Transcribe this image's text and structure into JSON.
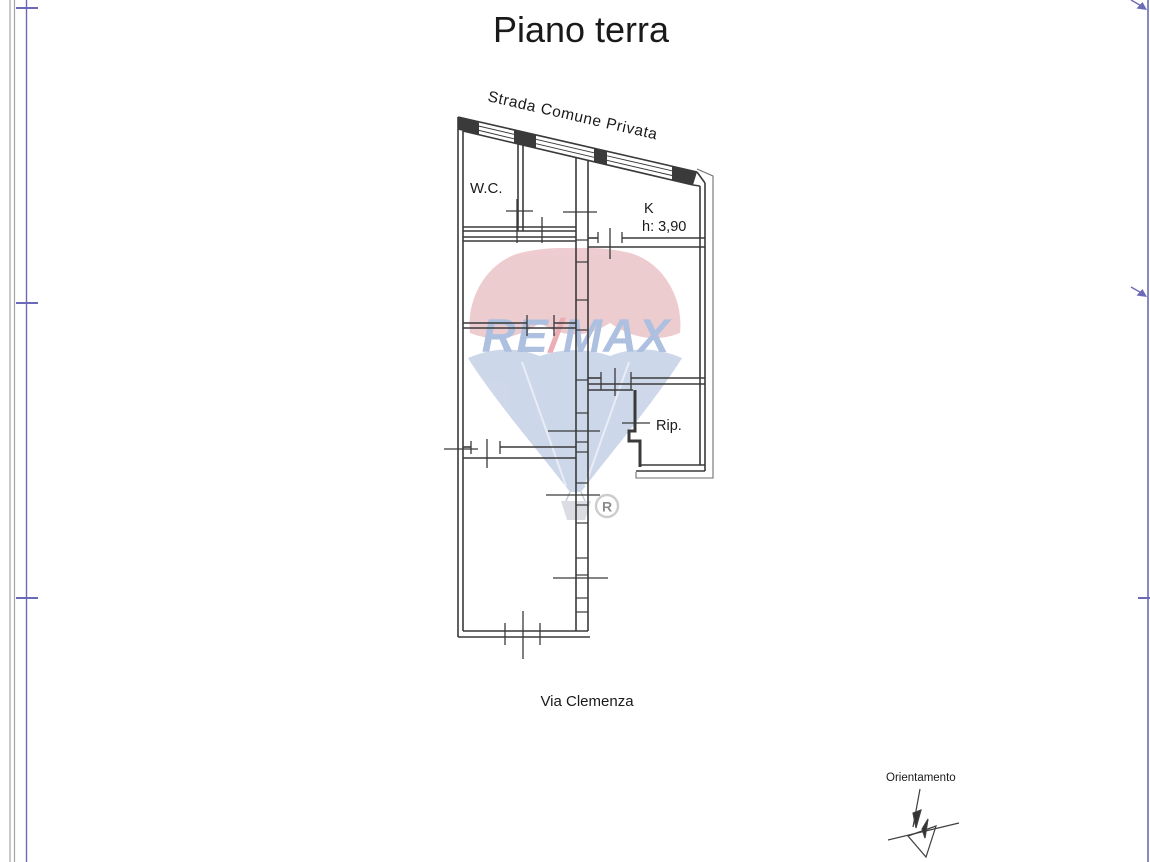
{
  "title": "Piano terra",
  "plan": {
    "street_top": "Strada Comune Privata",
    "street_bottom": "Via Clemenza",
    "room_wc": "W.C.",
    "room_kitchen": "K",
    "room_kitchen_height": "h: 3,90",
    "room_storage": "Rip."
  },
  "watermark": {
    "brand_re": "RE",
    "brand_slash": "/",
    "brand_max": "MAX",
    "registered": "R",
    "color_red": "#dd9aa2",
    "color_blue": "#9db1d6",
    "text_blue": "#5f82c0",
    "text_red": "#d9606e",
    "basket_gray": "#b9bdc6",
    "mark_gray": "#9a9a9a"
  },
  "compass": {
    "label": "Orientamento"
  },
  "frame": {
    "gray": "#a5a3a0",
    "blue": "#6a6ab8"
  }
}
